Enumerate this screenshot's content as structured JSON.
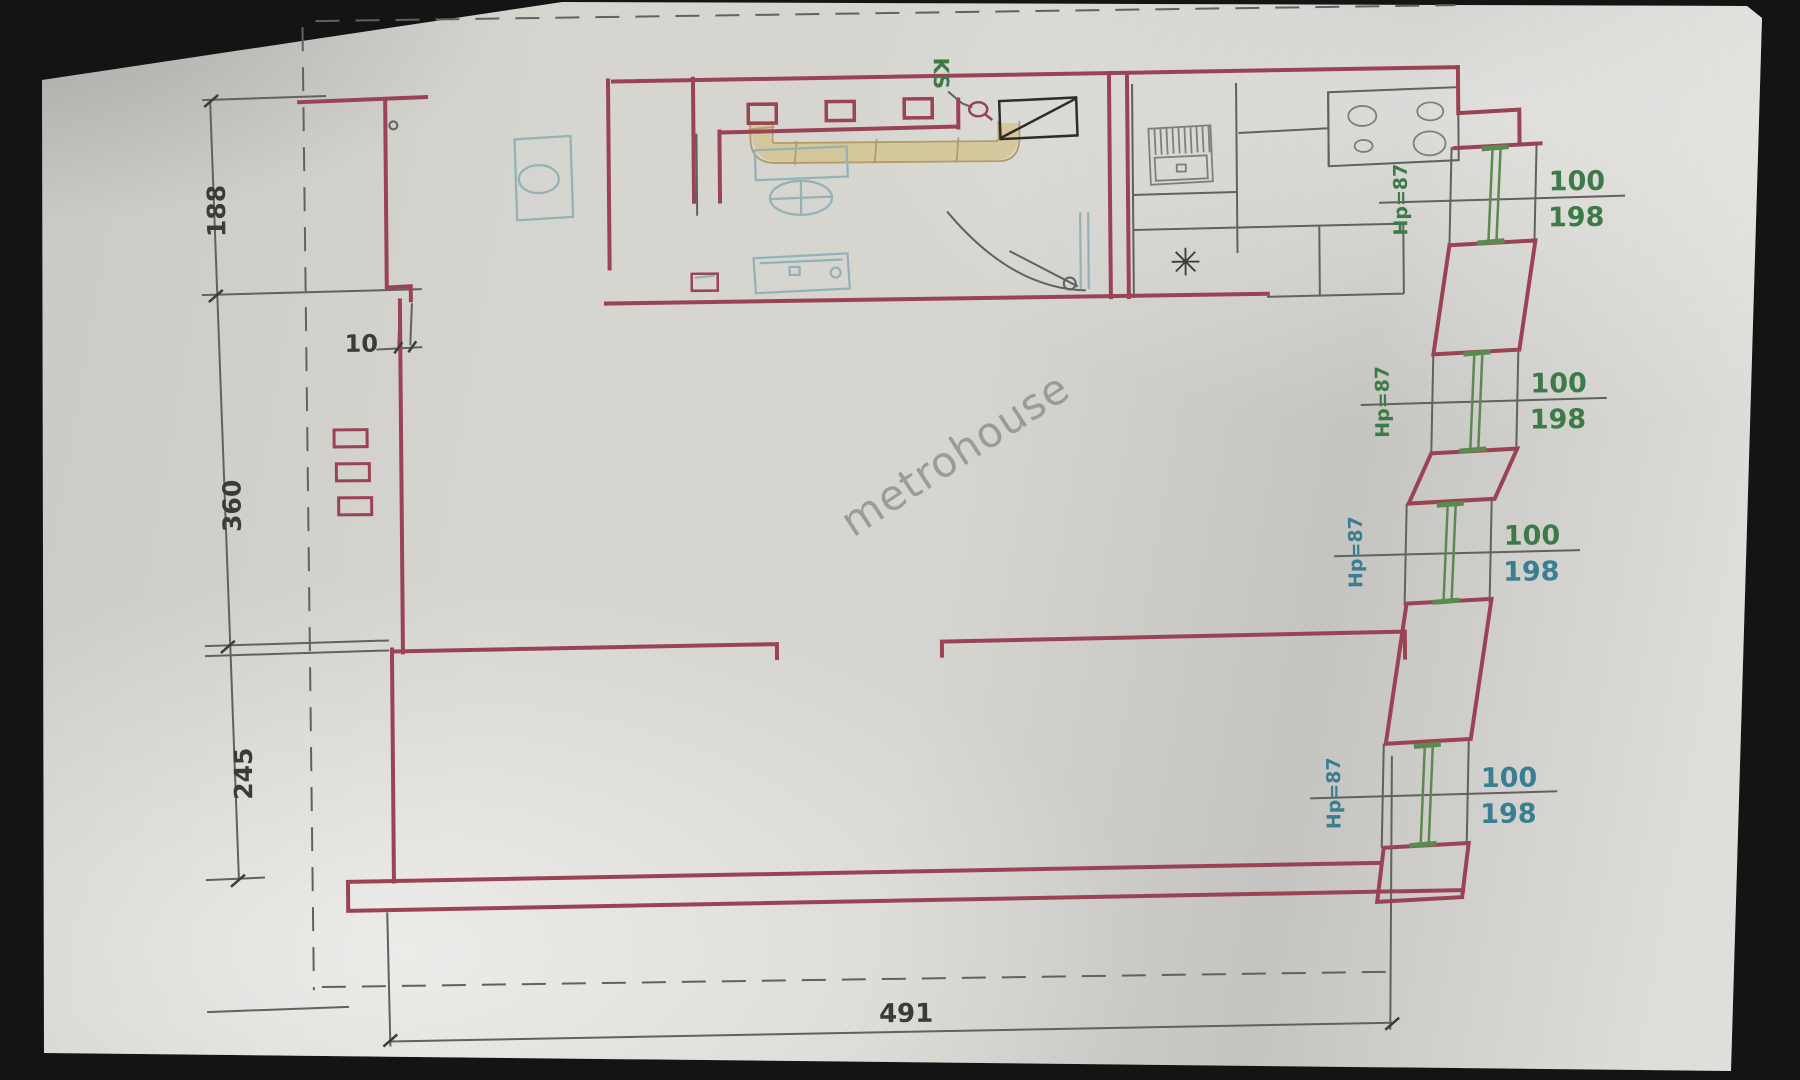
{
  "watermark": "metrohouse",
  "plan": {
    "dims": {
      "d188": "188",
      "d360": "360",
      "d245": "245",
      "d10": "10",
      "d491": "491"
    },
    "ks_label": "KS",
    "windows": [
      {
        "w": "100",
        "h": "198",
        "sill": "Hp=87"
      },
      {
        "w": "100",
        "h": "198",
        "sill": "Hp=87"
      },
      {
        "w": "100",
        "h": "198",
        "sill": "Hp=87"
      },
      {
        "w": "100",
        "h": "198",
        "sill": "Hp=87"
      }
    ],
    "colors": {
      "wall": "#9a4355",
      "pencil": "#5f625e",
      "dim_text": "#3a3c3a",
      "green": "#3c7a47",
      "teal": "#3a7e92",
      "fixture": "#92b2b6",
      "duct": "#d5c493",
      "duct_edge": "#b39c66",
      "paper": "#d6d5d0",
      "background": "#141414"
    }
  }
}
